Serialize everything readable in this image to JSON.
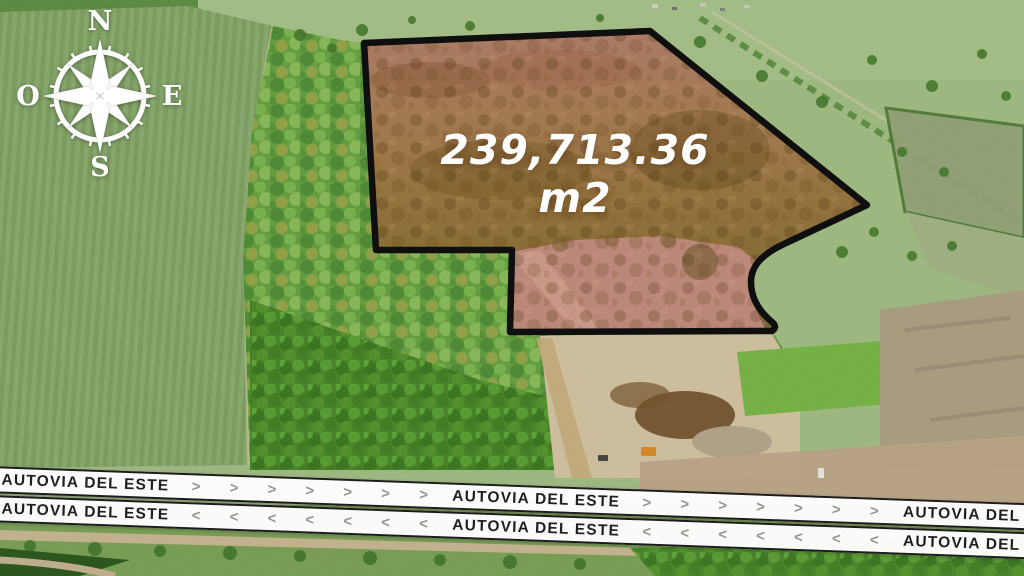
{
  "image_type": "aerial-property-listing",
  "compass": {
    "north": "N",
    "east": "E",
    "south": "S",
    "west": "O"
  },
  "parcel": {
    "area_label": "239,713.36 m2",
    "outline_color": "#101010",
    "overlay_tint": "#a5703f",
    "cleared_dirt_color": "#c69082"
  },
  "road": {
    "name": "AUTOVIA DEL ESTE",
    "eastbound": {
      "labels": [
        "AUTOVIA DEL ESTE",
        "AUTOVIA DEL ESTE",
        "AUTOVIA DEL ESTE"
      ],
      "chevrons": [
        "> > > > > > >",
        "> > > > > > >"
      ]
    },
    "westbound": {
      "labels": [
        "AUTOVIA DEL ESTE",
        "AUTOVIA DEL ESTE",
        "AUTOVIA DEL ESTE"
      ],
      "chevrons": [
        "< < < < < < <",
        "< < < < < < <"
      ]
    }
  }
}
